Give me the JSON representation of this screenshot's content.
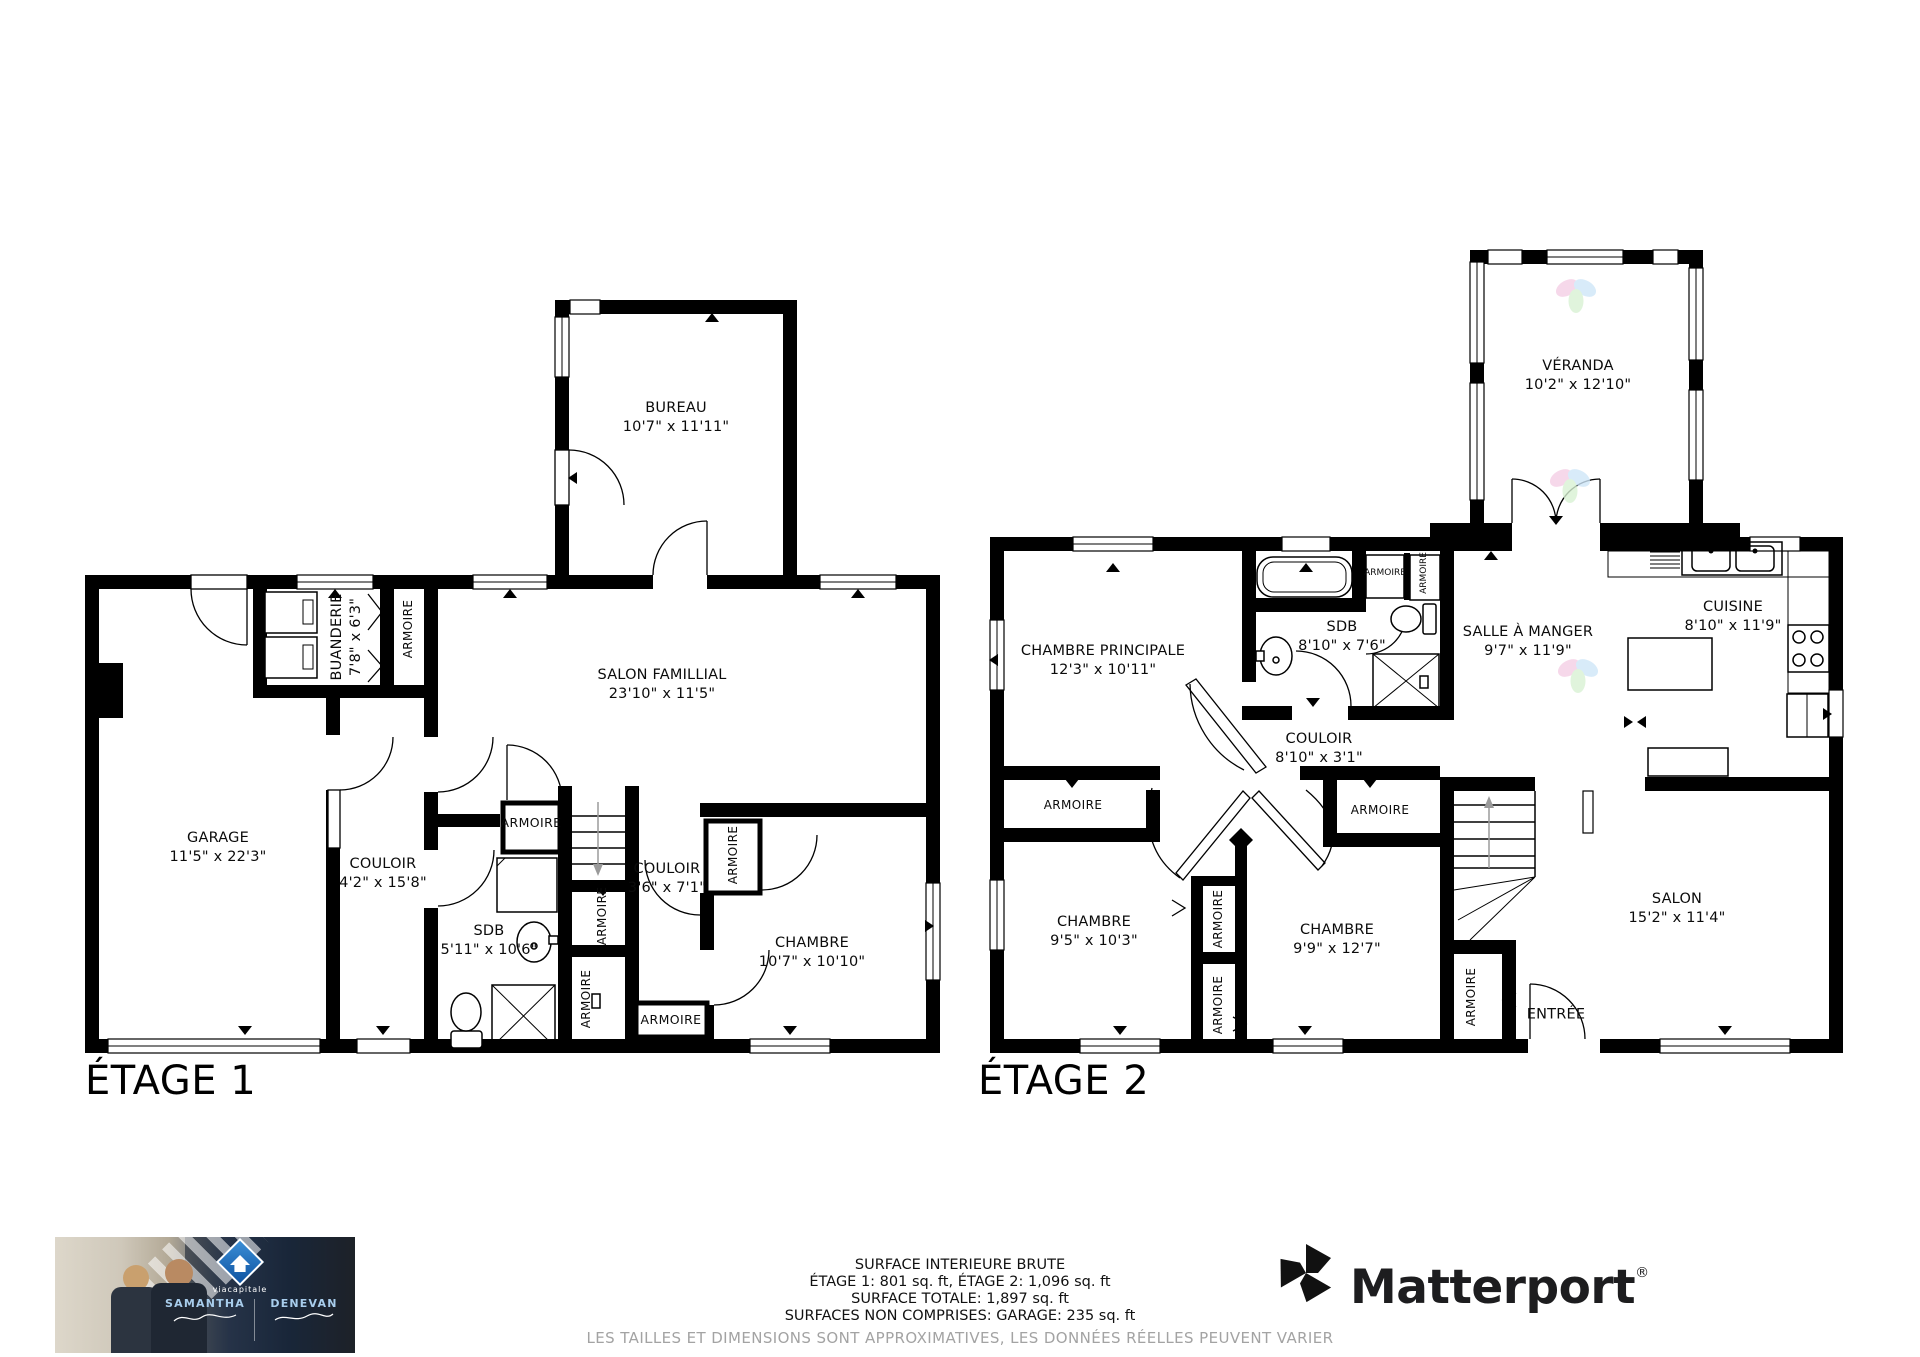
{
  "floor1": {
    "title": "ÉTAGE 1",
    "rooms": [
      {
        "name": "BUREAU",
        "dims": "10'7\" x 11'11\""
      },
      {
        "name": "SALON FAMILLIAL",
        "dims": "23'10\" x 11'5\""
      },
      {
        "name": "BUANDERIE",
        "dims": "7'8\" x 6'3\""
      },
      {
        "name": "GARAGE",
        "dims": "11'5\" x 22'3\""
      },
      {
        "name": "COULOIR",
        "dims": "4'2\" x 15'8\""
      },
      {
        "name": "SDB",
        "dims": "5'11\" x 10'6\""
      },
      {
        "name": "COULOIR",
        "dims": "3'6\" x 7'1\""
      },
      {
        "name": "CHAMBRE",
        "dims": "10'7\" x 10'10\""
      }
    ],
    "closets": [
      {
        "label": "ARMOIRE"
      },
      {
        "label": "ARMOIRE"
      },
      {
        "label": "ARMOIRE"
      },
      {
        "label": "ARMOIRE"
      },
      {
        "label": "ARMOIRE"
      },
      {
        "label": "ARMOIRE"
      }
    ]
  },
  "floor2": {
    "title": "ÉTAGE 2",
    "rooms": [
      {
        "name": "VÉRANDA",
        "dims": "10'2\" x 12'10\""
      },
      {
        "name": "CHAMBRE PRINCIPALE",
        "dims": "12'3\" x 10'11\""
      },
      {
        "name": "SDB",
        "dims": "8'10\" x 7'6\""
      },
      {
        "name": "SALLE À MANGER",
        "dims": "9'7\" x 11'9\""
      },
      {
        "name": "CUISINE",
        "dims": "8'10\" x 11'9\""
      },
      {
        "name": "COULOIR",
        "dims": "8'10\" x 3'1\""
      },
      {
        "name": "CHAMBRE",
        "dims": "9'5\" x 10'3\""
      },
      {
        "name": "CHAMBRE",
        "dims": "9'9\" x 12'7\""
      },
      {
        "name": "SALON",
        "dims": "15'2\" x 11'4\""
      },
      {
        "name": "ENTRÉE",
        "dims": ""
      }
    ],
    "closets": [
      {
        "label": "ARMOIRE"
      },
      {
        "label": "ARMOIRE"
      },
      {
        "label": "ARMOIRE"
      },
      {
        "label": "ARMOIRE"
      },
      {
        "label": "ARMOIRE"
      },
      {
        "label": "ARMOIRE"
      },
      {
        "label": "ARMOIRE"
      }
    ]
  },
  "summary": {
    "line1": "SURFACE INTERIEURE BRUTE",
    "line2": "ÉTAGE 1: 801 sq. ft, ÉTAGE 2: 1,096 sq. ft",
    "line3": "SURFACE TOTALE: 1,897 sq. ft",
    "line4": "SURFACES NON COMPRISES: GARAGE: 235 sq. ft",
    "disclaimer": "LES TAILLES ET DIMENSIONS SONT APPROXIMATIVES, LES DONNÉES RÉELLES PEUVENT VARIER"
  },
  "agents": {
    "brand": "viacapitale",
    "name1": "SAMANTHA",
    "name2": "DENEVAN"
  },
  "matterport": {
    "wordmark": "Matterport",
    "registered": "®"
  },
  "colors": {
    "wall": "#000000",
    "via_capitale_blue": "#0b4f9e",
    "disclaimer_gray": "#a3a3a3",
    "watermark_pink": "#f5cfe5",
    "watermark_blue": "#cfe7f8",
    "watermark_green": "#d9f2d4"
  }
}
